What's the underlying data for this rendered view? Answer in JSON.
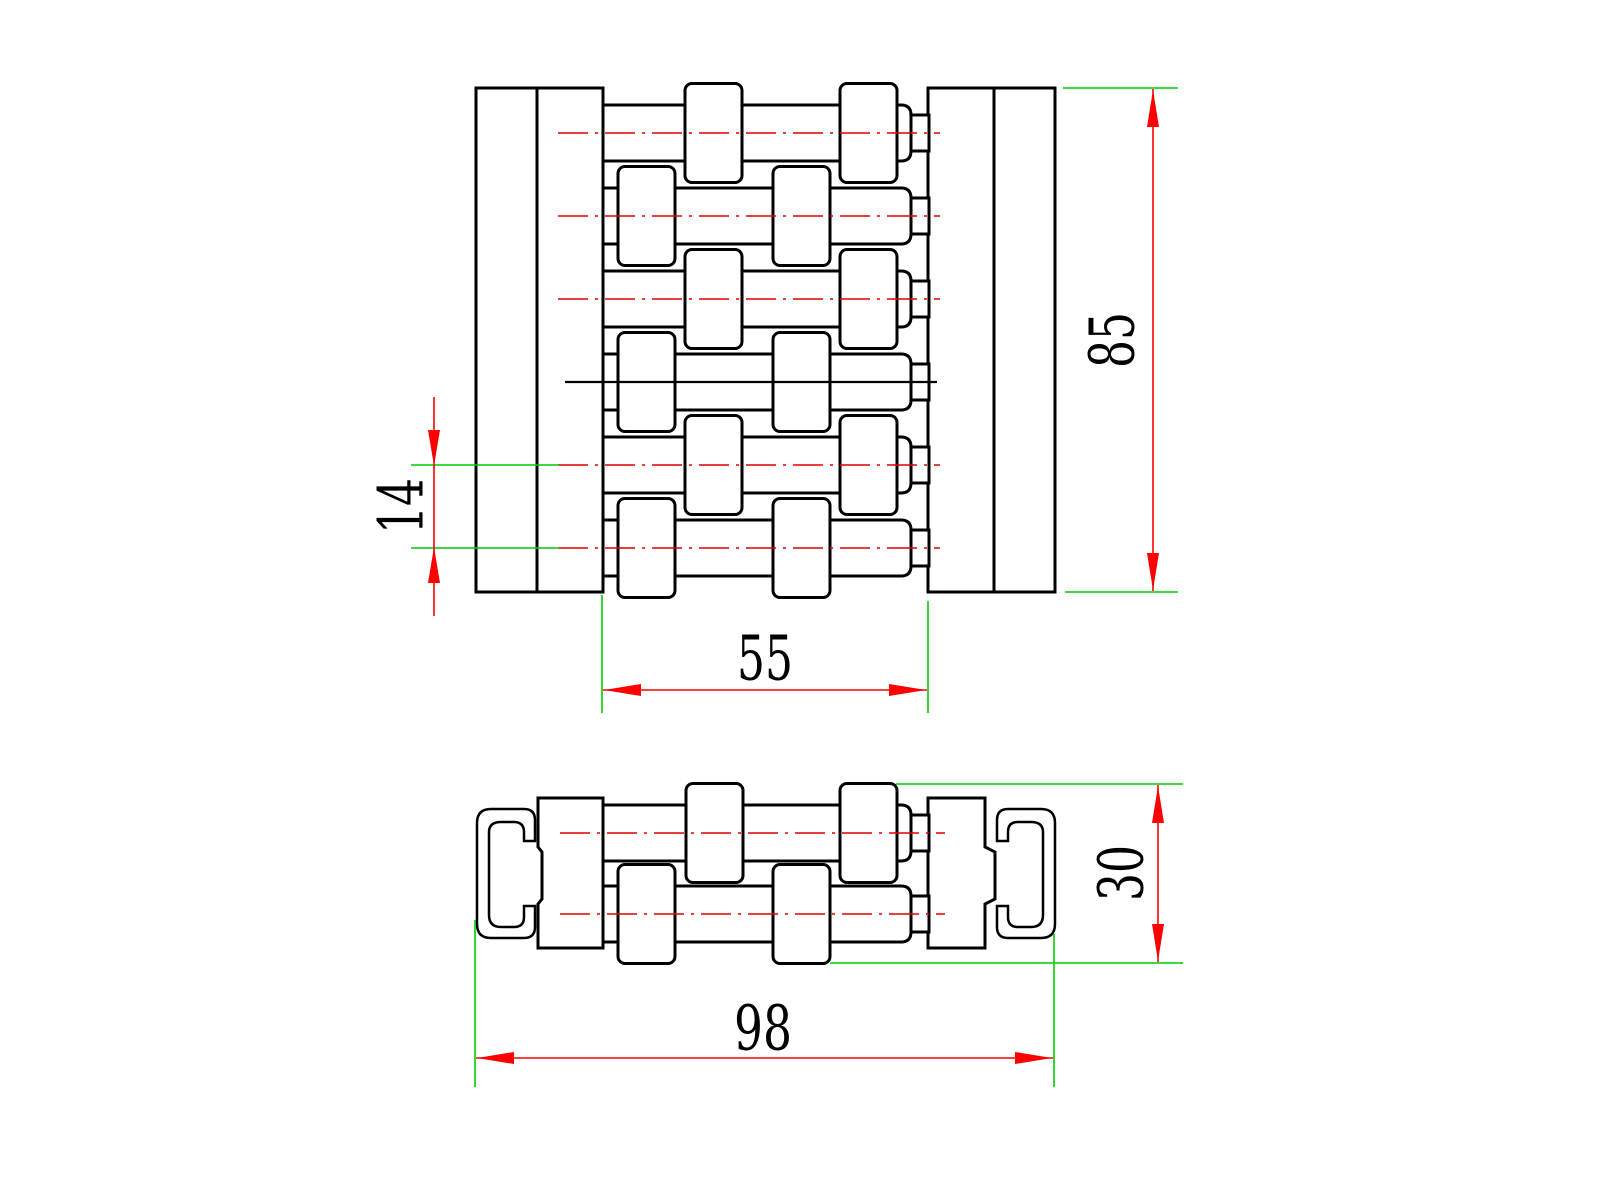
{
  "page": {
    "background": "#ffffff"
  },
  "dimensions": {
    "front_height": "85",
    "row_pitch": "14",
    "link_section_width": "55",
    "side_height": "30",
    "overall_width": "98"
  },
  "colors": {
    "outline": "#000000",
    "dimension_line": "#ff0000",
    "extension_line": "#00cc00",
    "centerline": "#dd0000"
  }
}
